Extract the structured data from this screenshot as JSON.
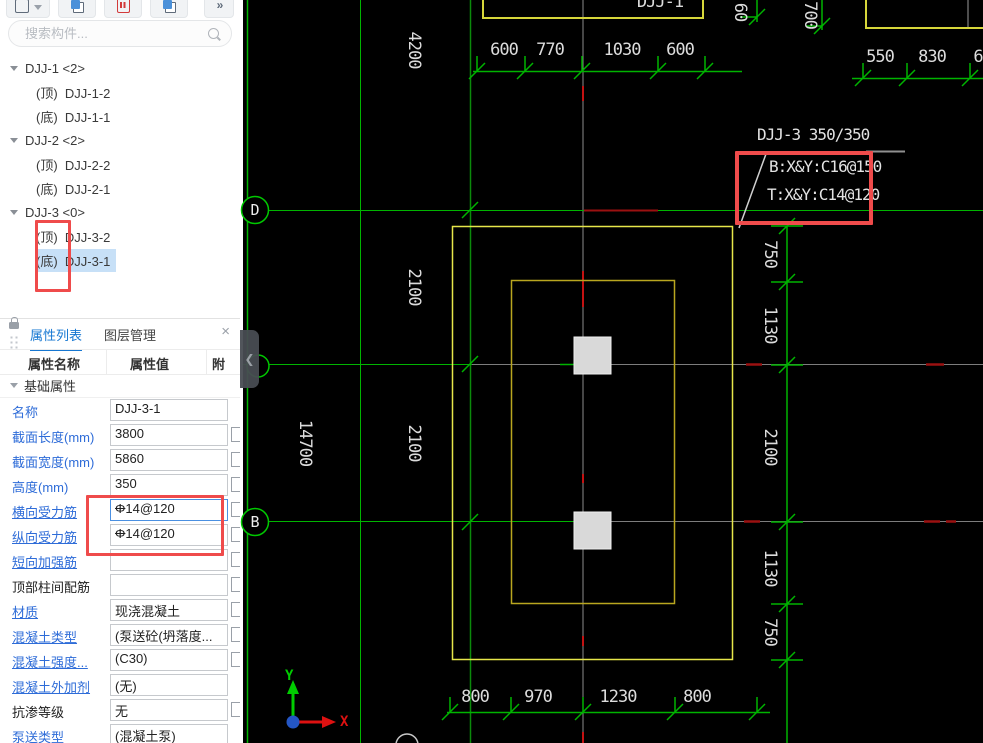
{
  "toolbar": {
    "more": "»"
  },
  "search": {
    "placeholder": "搜索构件..."
  },
  "tree": {
    "groups": [
      {
        "label": "DJJ-1 <2>",
        "children": [
          {
            "prefix": "(顶)",
            "name": "DJJ-1-2"
          },
          {
            "prefix": "(底)",
            "name": "DJJ-1-1"
          }
        ]
      },
      {
        "label": "DJJ-2 <2>",
        "children": [
          {
            "prefix": "(顶)",
            "name": "DJJ-2-2"
          },
          {
            "prefix": "(底)",
            "name": "DJJ-2-1"
          }
        ]
      },
      {
        "label": "DJJ-3 <0>",
        "children": [
          {
            "prefix": "(顶)",
            "name": "DJJ-3-2"
          },
          {
            "prefix": "(底)",
            "name": "DJJ-3-1"
          }
        ]
      }
    ]
  },
  "panel": {
    "tabs": [
      "属性列表",
      "图层管理"
    ],
    "close": "×",
    "columns": [
      "属性名称",
      "属性值",
      "附"
    ],
    "group": "基础属性",
    "rebar_symbol": "Φ",
    "rows": [
      {
        "label": "名称",
        "value": "DJJ-3-1"
      },
      {
        "label": "截面长度(mm)",
        "value": "3800"
      },
      {
        "label": "截面宽度(mm)",
        "value": "5860"
      },
      {
        "label": "高度(mm)",
        "value": "350"
      },
      {
        "label": "横向受力筋",
        "value": "14@120"
      },
      {
        "label": "纵向受力筋",
        "value": "14@120"
      },
      {
        "label": "短向加强筋",
        "value": ""
      },
      {
        "label": "顶部柱间配筋",
        "value": ""
      },
      {
        "label": "材质",
        "value": "现浇混凝土"
      },
      {
        "label": "混凝土类型",
        "value": "(泵送砼(坍落度..."
      },
      {
        "label": "混凝土强度...",
        "value": "(C30)"
      },
      {
        "label": "混凝土外加剂",
        "value": "(无)"
      },
      {
        "label": "抗渗等级",
        "value": "无"
      },
      {
        "label": "泵送类型",
        "value": "(混凝土泵)"
      }
    ]
  },
  "drawing": {
    "top_label": "DJJ-1",
    "bubbles": [
      "D",
      "B"
    ],
    "annotation": {
      "title": "DJJ-3 350/350",
      "line1": "B:X&Y:C16@150",
      "line2": "T:X&Y:C14@120"
    },
    "dims": {
      "top": [
        "600",
        "770",
        "1030",
        "600"
      ],
      "top_right": [
        "550",
        "830",
        "6"
      ],
      "top_mini": [
        "60",
        "700"
      ],
      "left": [
        "4200",
        "2100",
        "2100",
        "14700"
      ],
      "right": [
        "750",
        "1130",
        "2100",
        "1130",
        "750"
      ],
      "bottom": [
        "800",
        "970",
        "1230",
        "800"
      ]
    },
    "ucs": {
      "x": "X",
      "y": "Y"
    }
  }
}
